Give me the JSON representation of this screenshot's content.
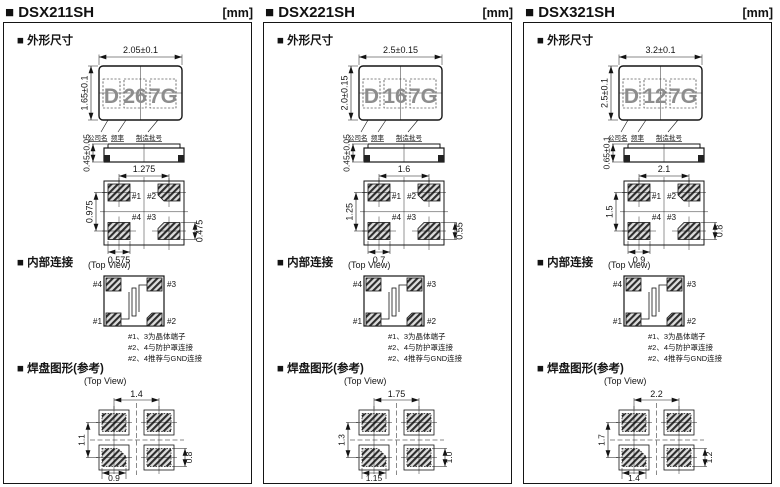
{
  "page": {
    "unit": "[mm]"
  },
  "labels": {
    "outline_section": "■ 外形尺寸",
    "internal_section": "■ 内部连接",
    "land_section": "■ 焊盘图形(参考)",
    "top_view": "(Top View)",
    "company": "公司名",
    "frequency": "频率",
    "lot": "制造批号",
    "pin1": "#1",
    "pin2": "#2",
    "pin3": "#3",
    "pin4": "#4",
    "notes": [
      "#1、3为晶体端子",
      "#2、4与防护罩连接",
      "#2、4推荐与GND连接"
    ]
  },
  "packages": [
    {
      "title": "■ DSX211SH",
      "marking": {
        "company_code": "D",
        "frequency_code": "26",
        "lot_code": "7G"
      },
      "outline": {
        "body_width": "2.05±0.1",
        "body_height": "1.65±0.1",
        "body_thickness": "0.45±0.05"
      },
      "bottom_pads": {
        "pitch_x": "1.275",
        "pitch_y": "0.975",
        "pad_width": "0.575",
        "pad_height": "0.475"
      },
      "land_pattern": {
        "pitch_x": "1.4",
        "pitch_y": "1.1",
        "pad_width": "0.9",
        "pad_height": "0.8"
      }
    },
    {
      "title": "■ DSX221SH",
      "marking": {
        "company_code": "D",
        "frequency_code": "16",
        "lot_code": "7G"
      },
      "outline": {
        "body_width": "2.5±0.15",
        "body_height": "2.0±0.15",
        "body_thickness": "0.45±0.05"
      },
      "bottom_pads": {
        "pitch_x": "1.6",
        "pitch_y": "1.25",
        "pad_width": "0.7",
        "pad_height": "0.55"
      },
      "land_pattern": {
        "pitch_x": "1.75",
        "pitch_y": "1.3",
        "pad_width": "1.15",
        "pad_height": "1.0"
      }
    },
    {
      "title": "■ DSX321SH",
      "marking": {
        "company_code": "D",
        "frequency_code": "12",
        "lot_code": "7G"
      },
      "outline": {
        "body_width": "3.2±0.1",
        "body_height": "2.5±0.1",
        "body_thickness": "0.65±0.1"
      },
      "bottom_pads": {
        "pitch_x": "2.1",
        "pitch_y": "1.5",
        "pad_width": "0.9",
        "pad_height": "0.8"
      },
      "land_pattern": {
        "pitch_x": "2.2",
        "pitch_y": "1.7",
        "pad_width": "1.4",
        "pad_height": "1.2"
      }
    }
  ]
}
